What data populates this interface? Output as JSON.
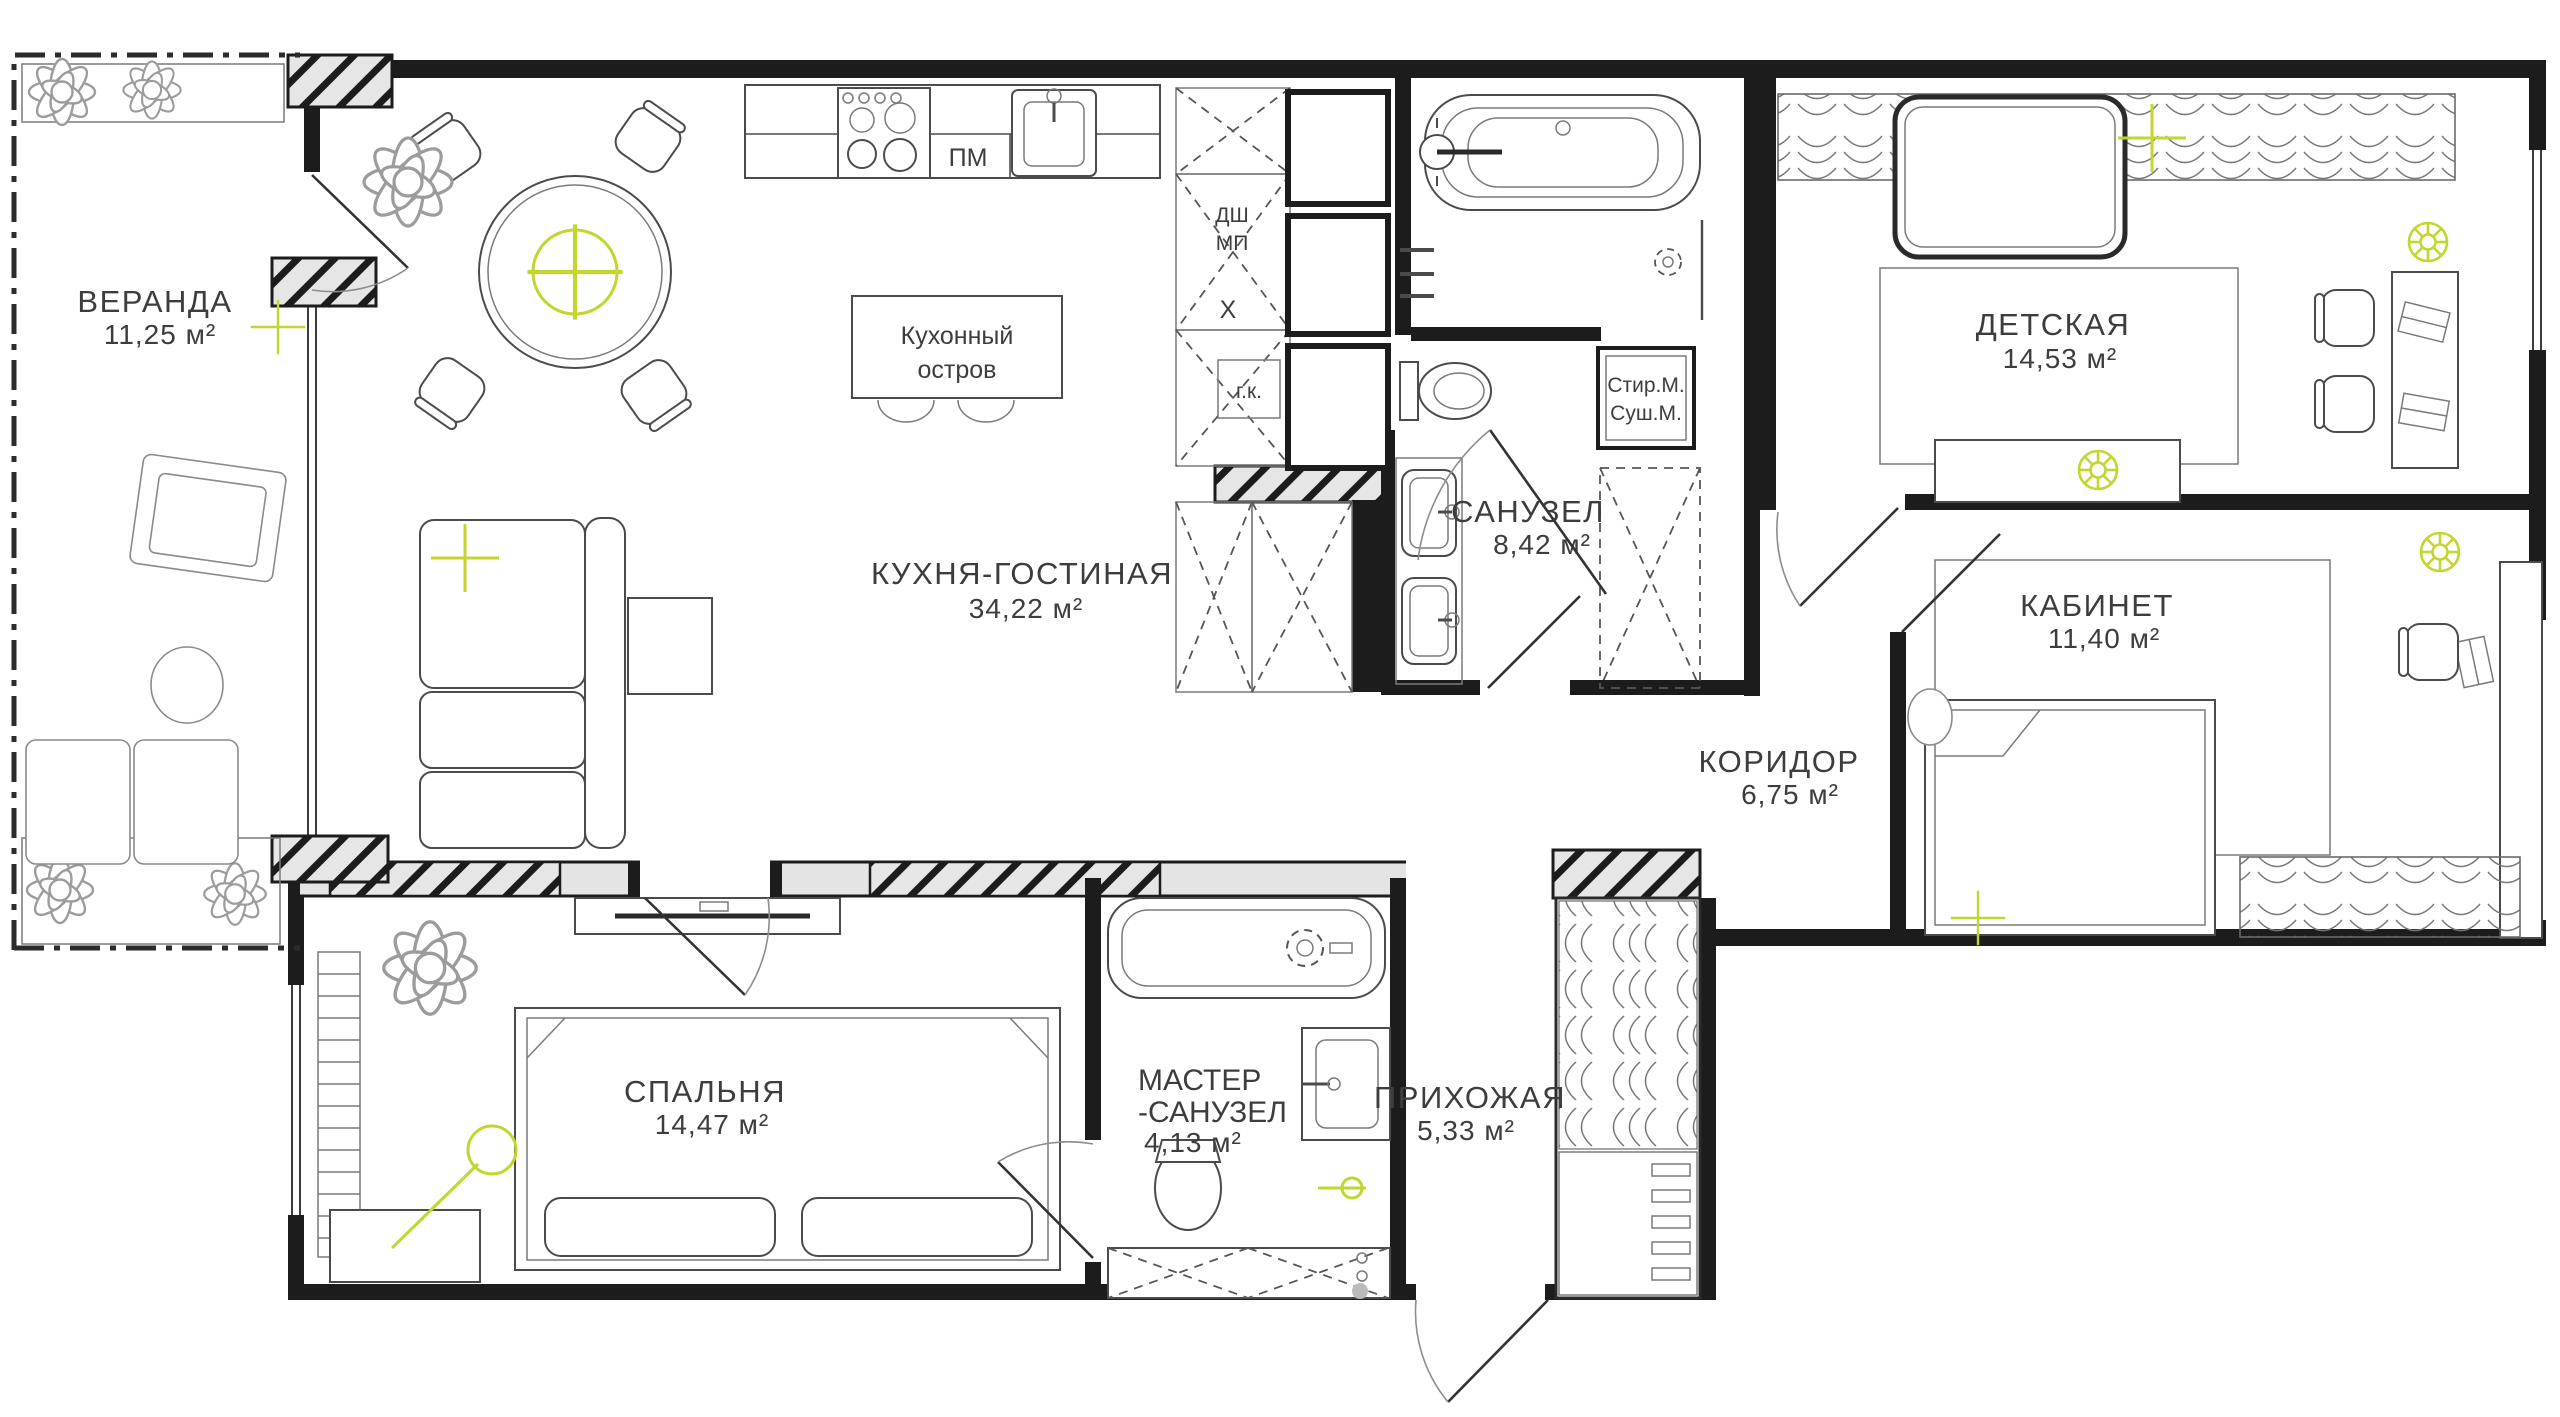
{
  "meta": {
    "type": "apartment-floor-plan",
    "language": "ru"
  },
  "colors": {
    "accent": "#c3d62e",
    "wall": "#1c1c1c",
    "wall_fill": "#e4e4e4",
    "background": "#ffffff",
    "text": "#3d3d3d"
  },
  "rooms": {
    "veranda": {
      "label": "ВЕРАНДА",
      "area": "11,25 м²"
    },
    "kitchen_living": {
      "label": "КУХНЯ-ГОСТИНАЯ",
      "area": "34,22 м²"
    },
    "bathroom": {
      "label": "САНУЗЕЛ",
      "area": "8,42 м²"
    },
    "children": {
      "label": "ДЕТСКАЯ",
      "area": "14,53 м²"
    },
    "office": {
      "label": "КАБИНЕТ",
      "area": "11,40 м²"
    },
    "corridor": {
      "label": "КОРИДОР",
      "area": "6,75 м²"
    },
    "bedroom": {
      "label": "СПАЛЬНЯ",
      "area": "14,47 м²"
    },
    "master_bath": {
      "label_line1": "МАСТЕР",
      "label_line2": "-САНУЗЕЛ",
      "area": "4,13 м²"
    },
    "hallway": {
      "label": "ПРИХОЖАЯ",
      "area": "5,33 м²"
    }
  },
  "fixtures": {
    "kitchen_island_line1": "Кухонный",
    "kitchen_island_line2": "остров",
    "dishwasher": "ПМ",
    "cabinet_line1": "ДШ",
    "cabinet_line2": "МП",
    "cabinet_x": "X",
    "hot_closet": "г.к.",
    "washer": "Стир.М.",
    "dryer": "Суш.М."
  }
}
